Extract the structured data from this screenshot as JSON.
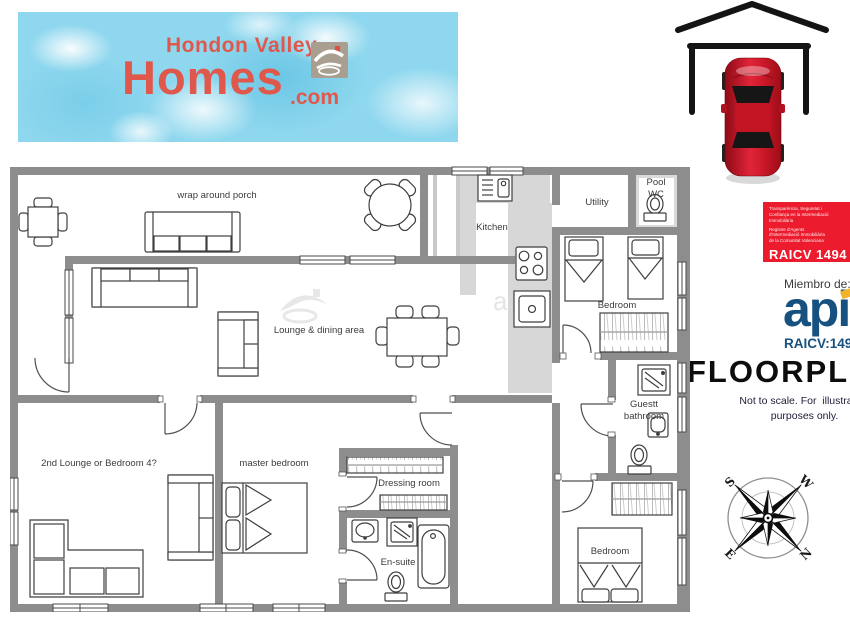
{
  "brand": {
    "line1": "Hondon Valley",
    "line2": "Homes",
    "suffix": ".com"
  },
  "badge": {
    "small": [
      "Transparència, Seguretat i",
      "Confiança en la Intermediació",
      "Immobiliària",
      "Registre d'Agents",
      "d'Intermediació Immobiliària",
      "de la Comunitat Valenciana"
    ],
    "code": "RAICV 1494"
  },
  "membership": {
    "prefix": "Miembro de:",
    "logo": "api",
    "number": "RAICV:1494"
  },
  "note": {
    "heading": "FLOORPLAN",
    "line1": "Not to scale. For  illustration",
    "line2": "purposes only."
  },
  "compass": {
    "n": "N",
    "s": "S",
    "e": "E",
    "w": "W"
  },
  "plan": {
    "watermark": "ale",
    "labels": {
      "porch": "wrap around porch",
      "lounge": "Lounge & dining area",
      "kitchen": "Kitchen",
      "utility": "Utility",
      "pool_wc": "Pool WC",
      "bedroom_top": "Bedroom",
      "guest_bathroom": "Guestt bathroom",
      "second_lounge": "2nd Lounge or Bedroom 4?",
      "master_bedroom": "master bedroom",
      "dressing_room": "Dressing room",
      "en_suite": "En-suite",
      "bedroom_bottom": "Bedroom"
    }
  },
  "colors": {
    "brand_coral": "#e0584c",
    "badge_red": "#ec1b2d",
    "api_blue": "#17517f",
    "api_yellow": "#f2b32a",
    "car_red": "#d01a2b",
    "wall_gray": "#8d8d8d",
    "water_blue": "#8ed7ee"
  }
}
